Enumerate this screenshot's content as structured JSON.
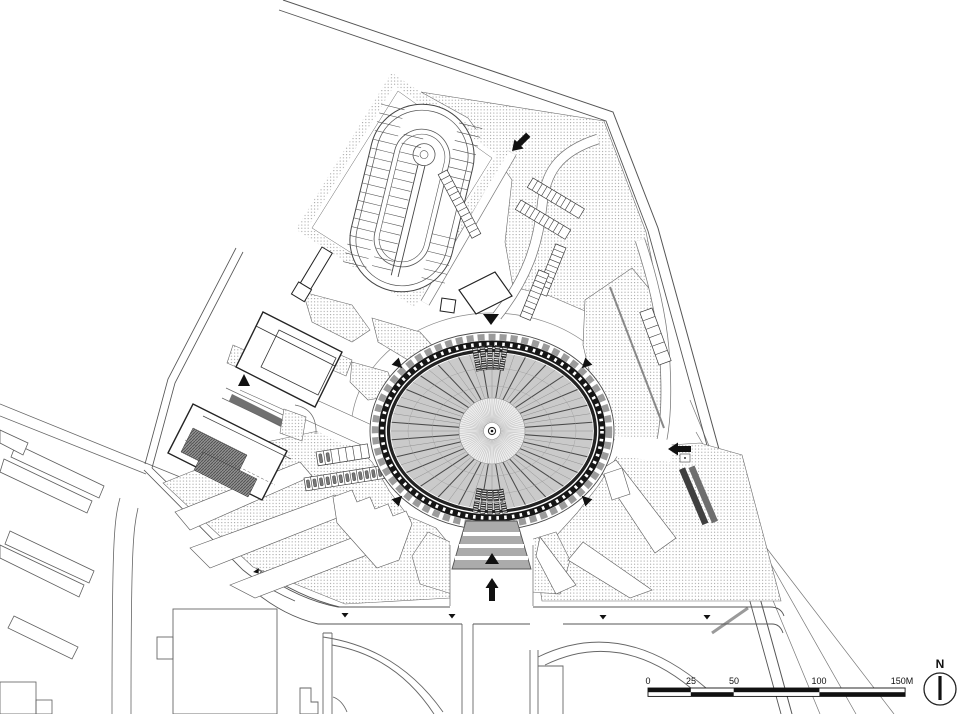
{
  "plan": {
    "type": "architectural-site-plan",
    "features": {
      "arena": "elliptical big-top arena with scalloped roof ring and radial cable roof",
      "ramp": "oval looping ramp structure in tilted rectangular enclosure",
      "parking": "stippled parking fields with white pedestrian wedge paths"
    }
  },
  "scale_bar": {
    "labels": [
      "0",
      "25",
      "50",
      "100",
      "150M"
    ],
    "values": [
      0,
      25,
      50,
      100,
      150
    ],
    "unit": "M"
  },
  "compass": {
    "north_label": "N"
  },
  "palette": {
    "ink": "#1a1a1a",
    "context_line": "#666666",
    "roof_gray": "#cacaca",
    "stipple_dot": "#9c9c9c",
    "fan_gray": "#ababab",
    "dark_fill": "#3f3f3f",
    "background": "#ffffff"
  }
}
